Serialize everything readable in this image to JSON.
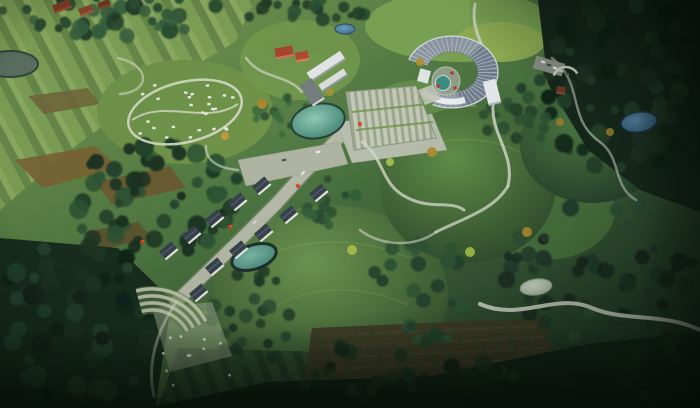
{
  "meta": {
    "title": "Aerial landscape masterplan rendering",
    "description": "Bird's-eye architectural rendering of a rural eco-park: striped farmland, forested hills, a crescent visitor center with stepped plaza, a village street with gabled houses, a camping loop, ponds and winding trails. No on-screen text.",
    "visible_text": []
  },
  "palette": {
    "field_light": "#7fa257",
    "field_mid": "#68894a",
    "field_bright": "#8fae62",
    "forest_dark": "#16281c",
    "forest_mid": "#2c4f33",
    "road": "#b6bba9",
    "path": "#d3d9c8",
    "pond_teal": "#47857a",
    "pond_blue": "#3f6f92",
    "roof_dark": "#38424d",
    "roof_crescent": "#8e99a4",
    "building_white": "#e9edef",
    "building_red": "#a84531",
    "vignette": "rgba(6,14,9,0.62)"
  },
  "scene": {
    "base": {
      "stops": [
        [
          "0%",
          "#7da055"
        ],
        [
          "45%",
          "#4e7742"
        ],
        [
          "100%",
          "#1b3123"
        ]
      ]
    },
    "farmland": {
      "polygon": "0,0 255,0 235,42 150,92 70,150 0,210",
      "stripes": {
        "size": 26,
        "bands": [
          [
            0,
            12,
            "#7fa257"
          ],
          [
            12,
            20,
            "#68894a"
          ],
          [
            20,
            26,
            "#8fae62"
          ]
        ],
        "angle": -28
      },
      "patches": [
        {
          "points": "15,160 95,146 120,168 42,188",
          "fill": "#7b6434"
        },
        {
          "points": "95,182 170,166 186,188 112,204",
          "fill": "#6e5a30"
        },
        {
          "points": "85,232 138,222 152,238 100,250",
          "fill": "#5d522e"
        },
        {
          "points": "28,96 88,88 100,104 44,114",
          "fill": "#72693c"
        }
      ],
      "lake": {
        "cx": 10,
        "cy": 64,
        "rx": 28,
        "ry": 13,
        "fill": "#5d7262",
        "stroke": "#31493a"
      }
    },
    "bottom_fields": {
      "points": "158,408 178,348 330,352 340,408",
      "stripes": {
        "size": 18,
        "bands": [
          [
            0,
            10,
            "#2f4e2e"
          ],
          [
            10,
            18,
            "#243f27"
          ]
        ],
        "angle": -20
      }
    },
    "orchard": {
      "polygon": "300,408 312,328 545,318 565,408",
      "soil": "#3f3b25",
      "row_line": "#574930",
      "dot": "#2b4626",
      "rows": 6,
      "dots_per_row": 14,
      "seed": 7
    },
    "lawns": [
      {
        "cx": 460,
        "cy": 26,
        "rx": 95,
        "ry": 36,
        "fill": "#7ca554",
        "op": 1
      },
      {
        "cx": 500,
        "cy": 42,
        "rx": 45,
        "ry": 20,
        "fill": "#93b055",
        "op": 0.9
      },
      {
        "cx": 185,
        "cy": 112,
        "rx": 88,
        "ry": 52,
        "fill": "#6f9449",
        "op": 1
      },
      {
        "cx": 300,
        "cy": 60,
        "rx": 60,
        "ry": 40,
        "fill": "#739a4e",
        "op": 0.9
      },
      {
        "cx": 185,
        "cy": 355,
        "rx": 72,
        "ry": 46,
        "fill": "#4d7540",
        "op": 1
      },
      {
        "cx": 420,
        "cy": 120,
        "rx": 60,
        "ry": 40,
        "fill": "#6a9350",
        "op": 0.8
      },
      {
        "cx": 545,
        "cy": 210,
        "rx": 70,
        "ry": 50,
        "fill": "#47703c",
        "op": 0.9
      }
    ],
    "hills": [
      {
        "cx": 330,
        "cy": 295,
        "rx": 118,
        "ry": 90,
        "c1": "#6d9750",
        "c2": "#314f2e"
      },
      {
        "cx": 468,
        "cy": 185,
        "rx": 88,
        "ry": 78,
        "c1": "#639049",
        "c2": "#2d4a2c"
      },
      {
        "cx": 592,
        "cy": 145,
        "rx": 72,
        "ry": 58,
        "c1": "#4f7a42",
        "c2": "#24402a"
      }
    ],
    "contours": [
      {
        "d": "M 255,260 Q 330,225 410,258",
        "op": 0.3
      },
      {
        "d": "M 268,310 Q 335,272 408,305",
        "op": 0.25
      },
      {
        "d": "M 415,150 Q 468,128 520,152",
        "op": 0.3
      }
    ],
    "forest_polys": [
      {
        "points": "538,0 700,0 700,212 640,190 588,150 548,84",
        "fill": "#16281c"
      },
      {
        "points": "0,238 118,248 172,300 155,408 0,408",
        "fill": "#182e1f"
      },
      {
        "points": "148,408 268,382 430,376 588,344 700,332 700,408",
        "fill": "#132518"
      }
    ],
    "clusters": [
      {
        "cx": 118,
        "cy": 16,
        "rx": 125,
        "ry": 20,
        "n": 42,
        "cols": [
          "#2c4f33",
          "#39603f",
          "#223e29"
        ],
        "r0": 4,
        "r1": 9,
        "seed": 1
      },
      {
        "cx": 300,
        "cy": 10,
        "rx": 70,
        "ry": 12,
        "n": 22,
        "cols": [
          "#2c4f33",
          "#223e29"
        ],
        "r0": 3,
        "r1": 7,
        "seed": 2
      },
      {
        "cx": 624,
        "cy": 86,
        "rx": 82,
        "ry": 88,
        "n": 60,
        "cols": [
          "#1b3322",
          "#234028",
          "#122419"
        ],
        "r0": 4,
        "r1": 10,
        "seed": 3
      },
      {
        "cx": 150,
        "cy": 198,
        "rx": 92,
        "ry": 58,
        "n": 55,
        "cols": [
          "#23422b",
          "#2e5434",
          "#1a3322"
        ],
        "r0": 4,
        "r1": 10,
        "seed": 4
      },
      {
        "cx": 74,
        "cy": 318,
        "rx": 92,
        "ry": 84,
        "n": 55,
        "cols": [
          "#1c3423",
          "#264630",
          "#12241a"
        ],
        "r0": 5,
        "r1": 11,
        "seed": 5
      },
      {
        "cx": 600,
        "cy": 268,
        "rx": 95,
        "ry": 75,
        "n": 48,
        "cols": [
          "#20392a",
          "#2b4d33",
          "#16291e"
        ],
        "r0": 4,
        "r1": 9,
        "seed": 6
      },
      {
        "cx": 330,
        "cy": 202,
        "rx": 36,
        "ry": 26,
        "n": 16,
        "cols": [
          "#2a4c31",
          "#356038"
        ],
        "r0": 3,
        "r1": 7,
        "seed": 14
      },
      {
        "cx": 282,
        "cy": 112,
        "rx": 30,
        "ry": 24,
        "n": 14,
        "cols": [
          "#2d5233",
          "#3a6a3e"
        ],
        "r0": 3,
        "r1": 6,
        "seed": 8
      },
      {
        "cx": 430,
        "cy": 290,
        "rx": 60,
        "ry": 55,
        "n": 26,
        "cols": [
          "#23422b",
          "#2e5434"
        ],
        "r0": 4,
        "r1": 8,
        "seed": 9
      },
      {
        "cx": 250,
        "cy": 320,
        "rx": 40,
        "ry": 55,
        "n": 24,
        "cols": [
          "#1f3a27",
          "#2a4c31"
        ],
        "r0": 4,
        "r1": 8,
        "seed": 10
      },
      {
        "cx": 520,
        "cy": 110,
        "rx": 40,
        "ry": 40,
        "n": 20,
        "cols": [
          "#23422b",
          "#2d5233"
        ],
        "r0": 3,
        "r1": 7,
        "seed": 11
      },
      {
        "cx": 400,
        "cy": 370,
        "rx": 120,
        "ry": 30,
        "n": 30,
        "cols": [
          "#142818",
          "#1d3522"
        ],
        "r0": 4,
        "r1": 9,
        "seed": 12
      },
      {
        "cx": 660,
        "cy": 330,
        "rx": 60,
        "ry": 70,
        "n": 25,
        "cols": [
          "#142818",
          "#1d3522"
        ],
        "r0": 4,
        "r1": 9,
        "seed": 13
      }
    ],
    "roads": {
      "main": {
        "pts": "348,128 322,155 305,172 276,204 244,236 209,270 176,302",
        "w": 12,
        "fill": "#b6bba9",
        "edge": "#878f7c"
      },
      "west_band": {
        "points": "238,160 340,142 348,164 246,186",
        "fill": "#afb5a2"
      },
      "apron": {
        "points": "336,122 432,114 447,150 352,163",
        "fill": "#b9bfae"
      },
      "lower_apron": {
        "points": "152,308 212,302 232,356 170,372",
        "fill": "#9cab8b",
        "op": 0.55
      }
    },
    "steps_plaza": {
      "points": "346,92 416,86 436,138 354,150",
      "size": 7,
      "bands": [
        [
          0,
          4,
          "#c6cbb7"
        ],
        [
          4,
          7,
          "#9ea892"
        ]
      ],
      "angle": -7,
      "green_lines": [
        {
          "d": "M 352,112 L 428,104"
        },
        {
          "d": "M 356,130 L 433,122"
        }
      ]
    },
    "terraces": {
      "cx": 152,
      "cy": 350,
      "radii": [
        40,
        47,
        54,
        61
      ],
      "a0": -105,
      "a1": -28,
      "stroke": "#c2c7b4",
      "w": 3.5,
      "wedge_fill": "#5f7f44"
    },
    "paths": [
      {
        "d": "M 475,4 C 468,42 502,62 494,98 C 487,132 516,152 508,186",
        "w": 3,
        "op": 0.85
      },
      {
        "d": "M 508,186 C 494,210 462,219 436,232",
        "w": 3,
        "op": 0.8
      },
      {
        "d": "M 480,304 C 520,322 556,292 592,308 C 625,322 662,312 700,330",
        "w": 4,
        "op": 0.9
      },
      {
        "d": "M 552,58 C 585,84 566,118 600,142 C 622,158 612,186 636,200",
        "w": 2.5,
        "op": 0.55
      },
      {
        "d": "M 246,58 C 262,80 288,74 302,92",
        "w": 2.5,
        "op": 0.7
      },
      {
        "d": "M 118,58 C 152,66 150,92 120,94",
        "w": 2.5,
        "op": 0.6
      },
      {
        "d": "M 436,232 C 415,248 380,246 360,230",
        "w": 2.5,
        "op": 0.6
      },
      {
        "d": "M 362,142 C 385,158 380,185 408,198 C 432,210 450,200 464,210",
        "w": 3,
        "op": 0.8
      },
      {
        "d": "M 238,170 C 215,168 205,158 206,146",
        "w": 2.5,
        "op": 0.6
      },
      {
        "d": "M 176,302 C 158,330 146,362 154,396",
        "w": 3,
        "op": 0.5
      }
    ],
    "campground": {
      "cx": 185,
      "cy": 112,
      "rx": 58,
      "ry": 30,
      "rot": -14,
      "loop_stroke": "#d8dcc9",
      "loop_w": 2.5,
      "inner_path": "M 132,120 C 165,98 205,126 238,104",
      "cabins": 26,
      "cabin_fill": "#e8eae3",
      "seed": 21
    },
    "water": [
      {
        "name": "plaza-pond",
        "cx": 318,
        "cy": 121,
        "rx": 27,
        "ry": 17,
        "rot": -12,
        "c1": "#8fcab5",
        "c2": "#3f7f6e",
        "stroke": "#27413a",
        "sw": 2
      },
      {
        "name": "village-pond",
        "cx": 254,
        "cy": 257,
        "rx": 23,
        "ry": 12,
        "rot": -18,
        "c1": "#7ab8a4",
        "c2": "#47857a",
        "stroke": "#20302a",
        "sw": 3
      },
      {
        "name": "north-pond",
        "cx": 345,
        "cy": 29,
        "rx": 10,
        "ry": 5,
        "rot": 0,
        "c1": "#6fa3c0",
        "c2": "#3f6f92",
        "stroke": "#2c4d66",
        "sw": 1
      },
      {
        "name": "east-pond",
        "cx": 639,
        "cy": 122,
        "rx": 18,
        "ry": 10,
        "rot": -8,
        "c1": "#5b8cab",
        "c2": "#35607f",
        "stroke": "#1d3a4a",
        "sw": 1.5
      },
      {
        "name": "south-pond",
        "cx": 536,
        "cy": 287,
        "rx": 16,
        "ry": 8,
        "rot": -8,
        "c1": "#cdd8c6",
        "c2": "#9fb29a",
        "stroke": "#87997f",
        "sw": 1
      }
    ],
    "visitor_center": {
      "cx": 452,
      "cy": 72,
      "squash": 0.78,
      "outer_r": 46,
      "inner_r": 26,
      "a0": 200,
      "a1": 475,
      "roof": "#8e99a4",
      "rib": "#cfd6dd",
      "rim": "#dde3e8",
      "east_tint": "rgba(45,65,95,0.28)",
      "wall_arc": {
        "r": 38,
        "a0": 70,
        "a1": 140,
        "stroke": "#eef2f4",
        "w": 6,
        "shadow": "#9aa3a9"
      },
      "end_block": {
        "x": 424,
        "y": 76,
        "w": 11,
        "h": 13,
        "rot": 15,
        "fill": "#e4e9ea"
      },
      "right_block": {
        "x": 492,
        "y": 92,
        "w": 13,
        "h": 24,
        "rot": -14,
        "fill": "#e9edef",
        "side": "#aeb6ba"
      },
      "court": {
        "cx": 446,
        "cy": 81,
        "r": 14,
        "fill": "#96a591",
        "ring": "#bfc9c0",
        "pool_cx": 443,
        "pool_cy": 83,
        "pool_r": 7.5,
        "pool": "#3d8f85"
      },
      "accents": [
        [
          452,
          73
        ],
        [
          438,
          86
        ],
        [
          455,
          88
        ]
      ],
      "accent_fill": "#c23b2a",
      "entry": "418,90 434,84 441,99 425,105",
      "entry_fill": "#c2c8b8"
    },
    "modern_building": [
      {
        "x": 326,
        "y": 66,
        "w": 40,
        "h": 10,
        "rot": -33,
        "fill": "#e4e8e6",
        "side": "#949c9a"
      },
      {
        "x": 333,
        "y": 80,
        "w": 30,
        "h": 8,
        "rot": -33,
        "fill": "#dce0de",
        "side": "#8b9391"
      },
      {
        "x": 312,
        "y": 92,
        "w": 14,
        "h": 24,
        "rot": -33,
        "fill": "#757d80",
        "side": "#dfe3e1"
      }
    ],
    "red_buildings": [
      {
        "x": 284,
        "y": 52,
        "w": 18,
        "h": 10,
        "rot": -10,
        "fill": "#a84531",
        "side": "#d8795c"
      },
      {
        "x": 302,
        "y": 56,
        "w": 13,
        "h": 9,
        "rot": -10,
        "fill": "#b04c33",
        "side": "#dd8262"
      }
    ],
    "farm_buildings": [
      {
        "x": 62,
        "y": 6,
        "w": 18,
        "h": 8,
        "rot": -20,
        "fill": "#7e3b26",
        "side": "#9c4f33"
      },
      {
        "x": 86,
        "y": 10,
        "w": 14,
        "h": 7,
        "rot": -20,
        "fill": "#8a452c",
        "side": "#a85a38"
      },
      {
        "x": 104,
        "y": 4,
        "w": 12,
        "h": 6,
        "rot": -20,
        "fill": "#6f3522",
        "side": "#8a462d"
      }
    ],
    "parking": {
      "lot": {
        "x": 549,
        "y": 66,
        "w": 30,
        "h": 13,
        "rot": 16,
        "fill": "#8b9389"
      },
      "cars": [
        [
          543,
          62
        ],
        [
          549,
          65
        ],
        [
          555,
          68
        ],
        [
          561,
          71
        ],
        [
          567,
          74
        ]
      ],
      "car_fills": [
        "#e6e8e4",
        "#3e464c",
        "#e6e8e4",
        "#c6cac6",
        "#565e64"
      ],
      "hut": {
        "x": 561,
        "y": 90,
        "w": 9,
        "h": 7,
        "rot": 10,
        "fill": "#6e3a28",
        "side": "#8a4a32"
      },
      "wall": {
        "cx": 566,
        "cy": 80,
        "r": 13,
        "a0": 200,
        "a1": 330,
        "stroke": "#ccd2c4",
        "w": 2.5
      }
    },
    "village": {
      "rot": -40,
      "w": 16,
      "h": 9,
      "roof": "#38424d",
      "ridge": "#5d6974",
      "wall": "#e7e7e1",
      "houses": [
        {
          "x": 168,
          "y": 250
        },
        {
          "x": 191,
          "y": 234
        },
        {
          "x": 214,
          "y": 218
        },
        {
          "x": 237,
          "y": 201
        },
        {
          "x": 261,
          "y": 185
        },
        {
          "x": 214,
          "y": 266
        },
        {
          "x": 238,
          "y": 249
        },
        {
          "x": 263,
          "y": 232
        },
        {
          "x": 288,
          "y": 214
        },
        {
          "x": 318,
          "y": 192
        },
        {
          "x": 198,
          "y": 292
        }
      ]
    },
    "road_cars": [
      {
        "x": 303,
        "y": 173,
        "rot": -42,
        "fill": "#e8e8e4"
      },
      {
        "x": 255,
        "y": 222,
        "rot": -42,
        "fill": "#d8d8d2"
      },
      {
        "x": 284,
        "y": 160,
        "rot": -10,
        "fill": "#4a5258"
      },
      {
        "x": 318,
        "y": 152,
        "rot": -10,
        "fill": "#e8e8e4"
      }
    ],
    "sheep": {
      "cx": 190,
      "cy": 362,
      "rx": 46,
      "ry": 30,
      "n": 11,
      "fill": "#e9ece6",
      "seed": 31
    },
    "flowers": {
      "pts": [
        [
          360,
          124
        ],
        [
          298,
          186
        ],
        [
          230,
          227
        ],
        [
          142,
          242
        ]
      ],
      "fill": "#cc3e22"
    },
    "autumn_trees": [
      {
        "x": 262,
        "y": 104,
        "r": 5,
        "fill": "#b5862f"
      },
      {
        "x": 225,
        "y": 136,
        "r": 4,
        "fill": "#c49a3a"
      },
      {
        "x": 330,
        "y": 92,
        "r": 4,
        "fill": "#a5913a"
      },
      {
        "x": 432,
        "y": 152,
        "r": 5,
        "fill": "#b08d35"
      },
      {
        "x": 527,
        "y": 232,
        "r": 5,
        "fill": "#a8862f"
      },
      {
        "x": 560,
        "y": 122,
        "r": 4,
        "fill": "#99802e"
      },
      {
        "x": 420,
        "y": 62,
        "r": 4,
        "fill": "#b5952f"
      },
      {
        "x": 610,
        "y": 132,
        "r": 4,
        "fill": "#8f7a2c"
      },
      {
        "x": 352,
        "y": 250,
        "r": 5,
        "fill": "#a9c14e"
      },
      {
        "x": 470,
        "y": 252,
        "r": 5,
        "fill": "#9fbb49"
      },
      {
        "x": 390,
        "y": 162,
        "r": 4,
        "fill": "#a9c14e"
      }
    ],
    "vignette": {
      "outer": "rgba(6,14,9,0.62)",
      "corner_tr": "rgba(4,10,7,0.55)",
      "bottom": "rgba(3,8,5,0.55)",
      "right": "rgba(4,10,7,0.45)"
    }
  }
}
